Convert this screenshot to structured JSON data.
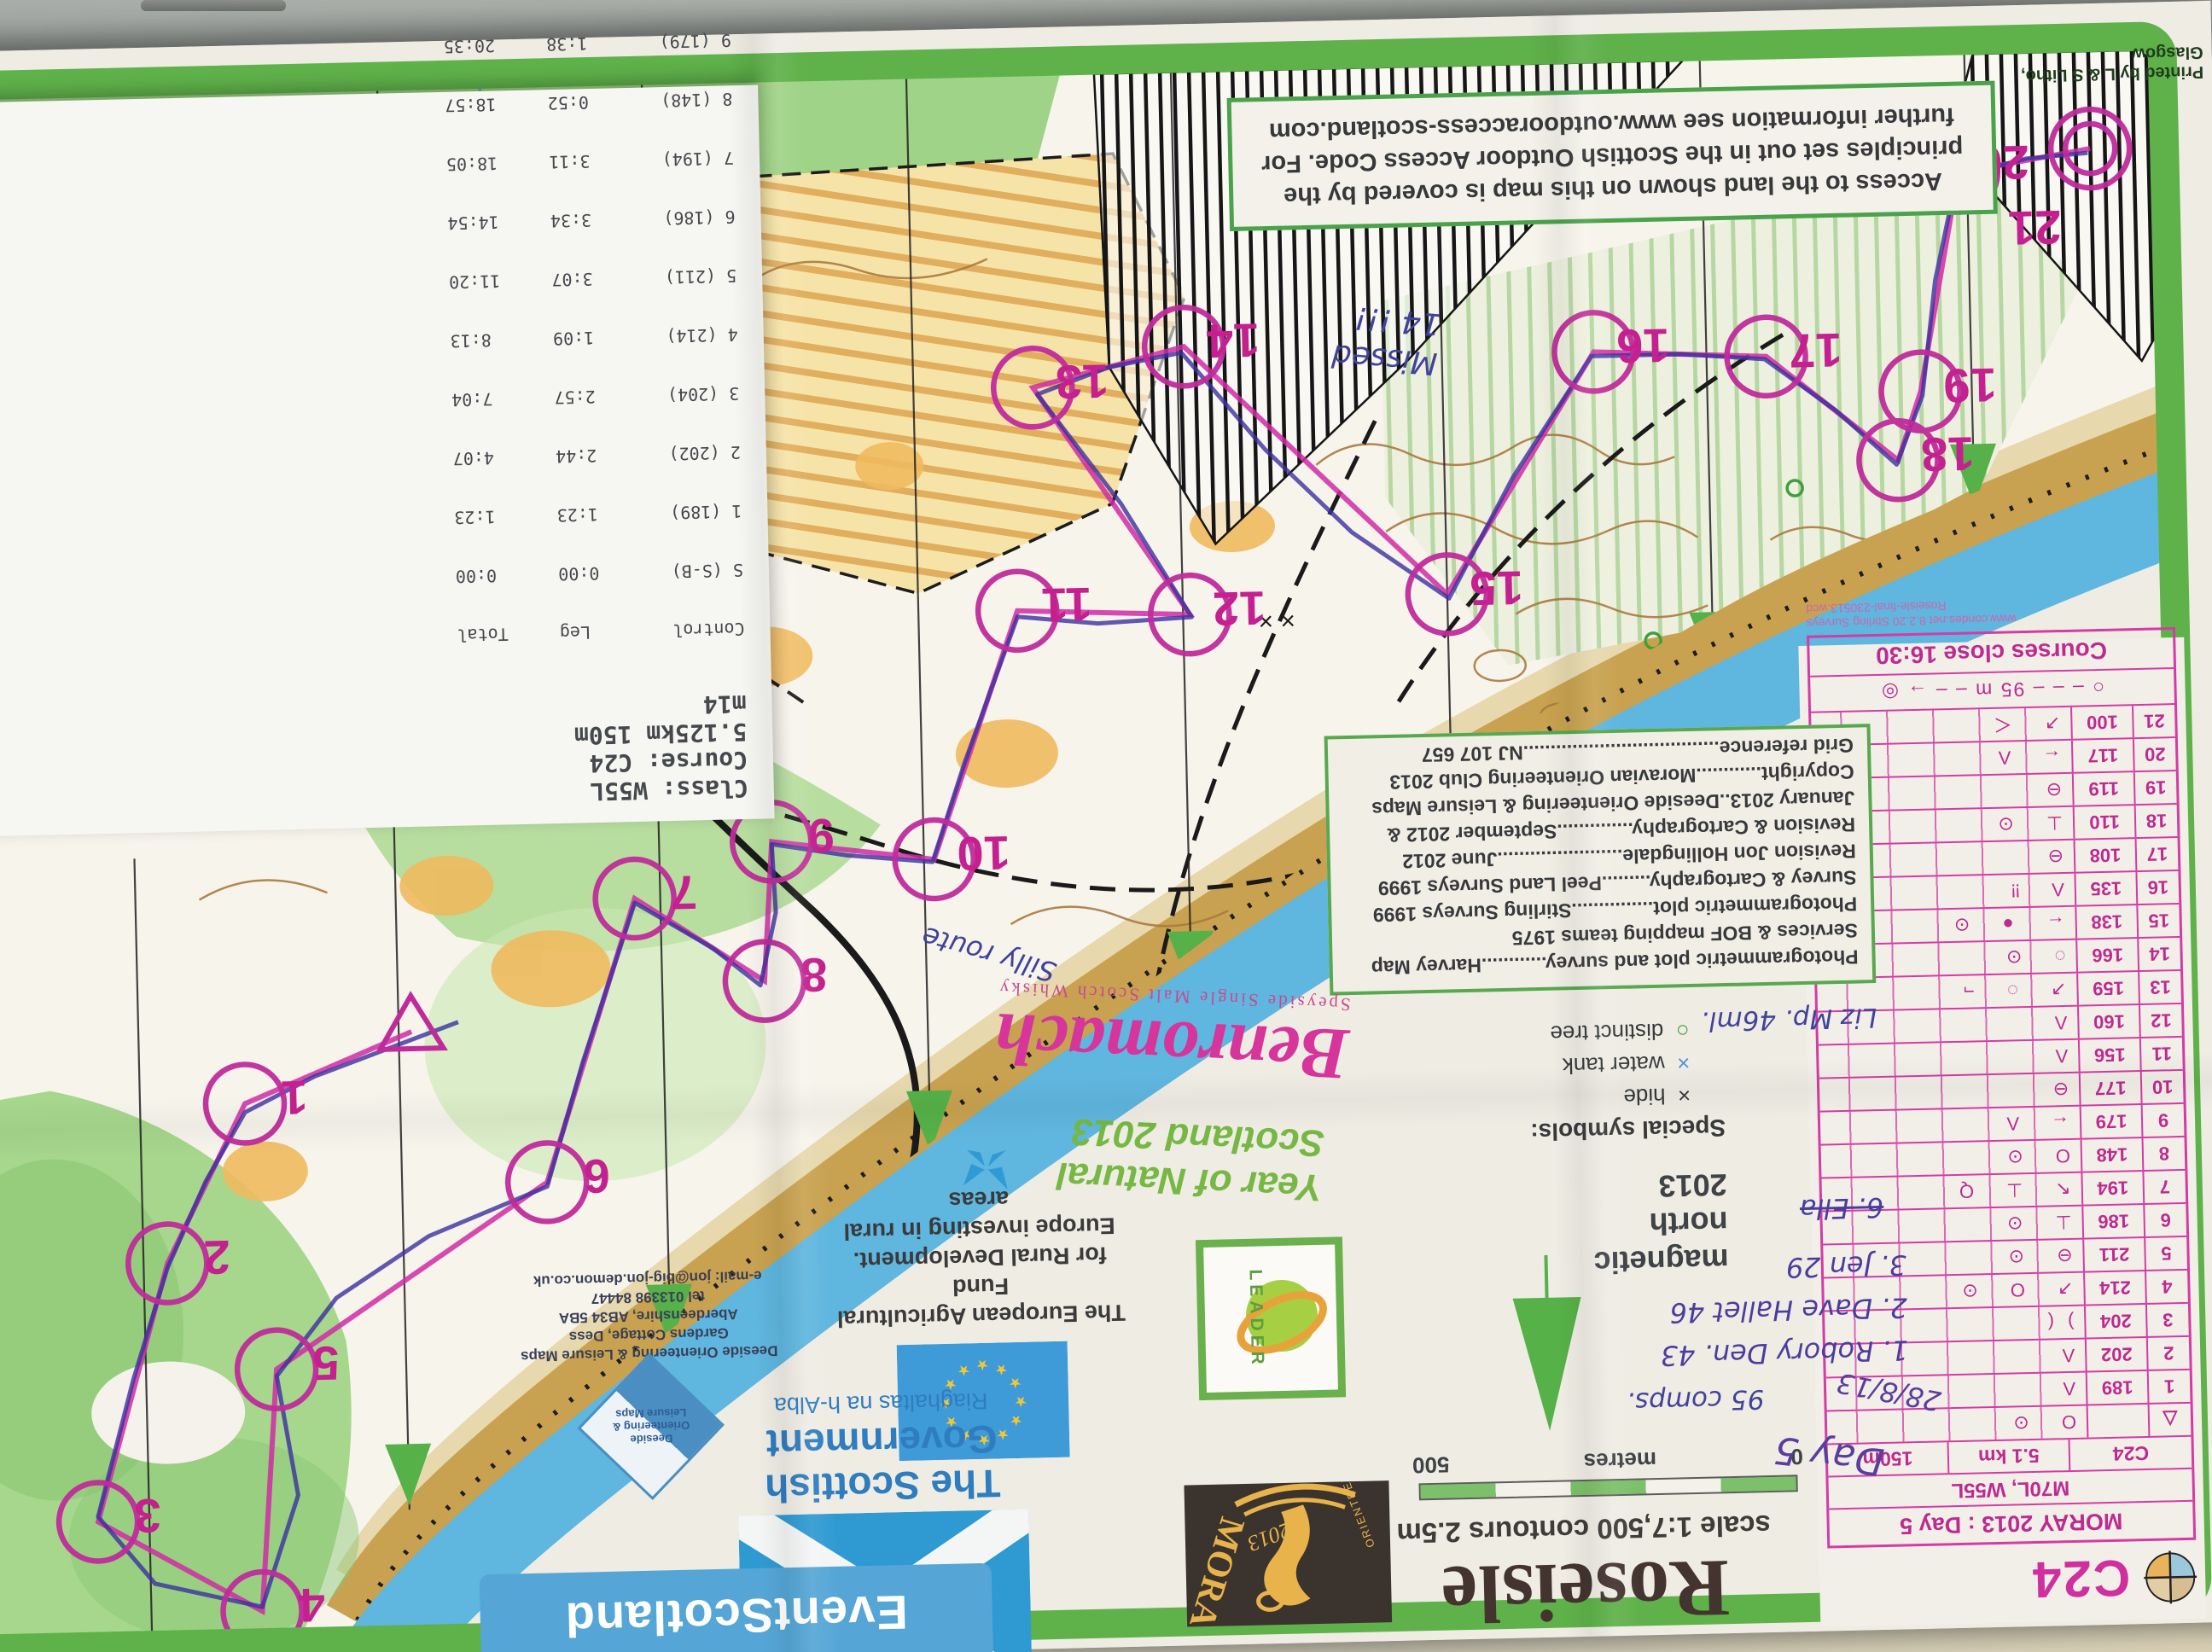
{
  "results_card": {
    "class_line": "Class: W55L",
    "course_line": "Course: C24",
    "distance_line": "5.125km 150m",
    "competitor_line": "m14",
    "header": "Control        Leg     Total",
    "rows": [
      "S (S-B)       0:00      0:00",
      "1 (189)       1:23      1:23",
      "2 (202)       2:44      4:07",
      "3 (204)       2:57      7:04",
      "4 (214)       1:09      8:13",
      "5 (211)       3:07     11:20",
      "6 (186)       3:34     14:54",
      "7 (194)       3:11     18:05",
      "8 (148)       0:52     18:57",
      "9 (179)       1:38     20:35",
      "10 (177)      0:53     21:28",
      "11 (156)      4:16     25:44",
      "12 (160)      1:49     27:33",
      "13 (159)      2:27     30:00",
      "14 (166)     -----     -----",
      "15 (138)     -----     33:55",
      "16 (135)      3:51     37:46",
      "17 (108)      1:40     39:26",
      "18 (110)      2:05     41:31",
      "19 (119)      0:25     41:56",
      "20 (117)      2:33     44:29",
      "21 (100)      1:29     45:58",
      "F (F)         0:21     46:19"
    ],
    "current_leader": "Current leader 43:02",
    "footer": [
      "AutoDownload",
      "SPORTident Event Timing Solution",
      "http://www.sportident.co.uk"
    ]
  },
  "access_box": {
    "lines": [
      "Access to the land shown on this map is covered by the",
      "principles set out in the Scottish Outdoor Access Code.  For",
      "further information see   www.outdooraccess-scotland.com"
    ]
  },
  "printed_by": "Printed by L & S Litho, Glasgow",
  "control_card": {
    "code": "C24",
    "event": "MORAY 2013 : Day 5",
    "classes": "M70L, W55L",
    "course": "C24",
    "length": "5.1 km",
    "climb": "150m",
    "start_symbol": "△",
    "start_syms": "O  ⊙",
    "rows": [
      {
        "n": "1",
        "code": "189",
        "syms": "Λ"
      },
      {
        "n": "2",
        "code": "202",
        "syms": "Λ"
      },
      {
        "n": "3",
        "code": "204",
        "syms": ")("
      },
      {
        "n": "4",
        "code": "214",
        "syms": "↗ O ⊙"
      },
      {
        "n": "5",
        "code": "211",
        "syms": "⊖ ⊙"
      },
      {
        "n": "6",
        "code": "186",
        "syms": "⊥ ⊙"
      },
      {
        "n": "7",
        "code": "194",
        "syms": "↖ ⊥ Q"
      },
      {
        "n": "8",
        "code": "148",
        "syms": "O ⊙"
      },
      {
        "n": "9",
        "code": "179",
        "syms": "← Λ"
      },
      {
        "n": "10",
        "code": "177",
        "syms": "⊖"
      },
      {
        "n": "11",
        "code": "156",
        "syms": "Λ"
      },
      {
        "n": "12",
        "code": "160",
        "syms": "Λ"
      },
      {
        "n": "13",
        "code": "159",
        "syms": "↗ ◌ ¬"
      },
      {
        "n": "14",
        "code": "166",
        "syms": "◌ ⊙"
      },
      {
        "n": "15",
        "code": "138",
        "syms": "← ● ⊙"
      },
      {
        "n": "16",
        "code": "135",
        "syms": "Λ ‼"
      },
      {
        "n": "17",
        "code": "108",
        "syms": "⊖"
      },
      {
        "n": "18",
        "code": "110",
        "syms": "⊥ ⊙"
      },
      {
        "n": "19",
        "code": "119",
        "syms": "⊖"
      },
      {
        "n": "20",
        "code": "117",
        "syms": "← Λ"
      },
      {
        "n": "21",
        "code": "100",
        "syms": "↗ ＜"
      }
    ],
    "finish_row": "○ – – –  95 m  – – → ◎",
    "closes": "Courses close 16:30",
    "small_print": [
      "www.condes.net 8.2.20 Stirling Surveys",
      "Roseisle-final-230513.wcd"
    ]
  },
  "map": {
    "title": "Roseisle",
    "scale_line": "scale 1:7,500   contours 2.5m",
    "scale_bar": {
      "left": "0",
      "mid": "metres",
      "right": "500"
    },
    "north": {
      "line1": "magnetic",
      "line2": "north",
      "line3": "2013"
    },
    "credits": [
      "Photogrammetric plot and survey............Harvey Map",
      "Services & BOF mapping teams 1975",
      "Photogrammetric plot...............Stirling Surveys 1999",
      "Survey & Cartography.........Peel Land Surveys 1999",
      "Revision Jon Hollingdale.......................June 2012",
      "Revision & Cartography..............September 2012 &",
      "January 2013..Deeside Orienteering & Leisure Maps",
      "Copyright............Moravian Orienteering Club 2013",
      "Grid reference....................................NJ 107 657"
    ],
    "special_symbols": {
      "title": "Special symbols:",
      "items": [
        {
          "sym": "×",
          "label": "hide",
          "color": "#3a3a3a"
        },
        {
          "sym": "×",
          "label": "water tank",
          "color": "#5a8fd8"
        },
        {
          "sym": "○",
          "label": "distinct tree",
          "color": "#3da03d"
        }
      ]
    },
    "control_labels": [
      "1",
      "2",
      "3",
      "4",
      "5",
      "6",
      "7",
      "8",
      "9",
      "10",
      "11",
      "12",
      "13",
      "14",
      "15",
      "16",
      "17",
      "18",
      "19",
      "20",
      "21"
    ],
    "colors": {
      "frame": "#5fb14a",
      "course": "#c02b9b",
      "sea": "#5fb6df",
      "forest": "#9fd387",
      "dune": "#c8a250",
      "arrow": "#56b148"
    }
  },
  "logos": {
    "moray": {
      "name": "MORAY",
      "year": "2013",
      "arc": "ORIENTEERING"
    },
    "leader": "LEADER",
    "eu": {
      "lines": [
        "The European Agricultural Fund",
        "for Rural Development.",
        "Europe investing in rural areas"
      ]
    },
    "scotgov": {
      "line1": "The Scottish",
      "line2": "Government",
      "gaelic": "Riaghaltas na h-Alba"
    },
    "eventscotland": "EventScotland",
    "deeside": {
      "diamond": "Deeside Orienteering & Leisure Maps",
      "contact": [
        "Deeside Orienteering & Leisure Maps",
        "Gardens Cottage, Dess",
        "Aberdeenshire, AB34 5BA",
        "tel 013398 84447",
        "e-mail:  jon@big-jon.demon.co.uk"
      ]
    },
    "benromach": {
      "name": "Benromach",
      "tagline": "Speyside Single Malt Scotch Whisky"
    },
    "natural_scotland": {
      "line1": "Year of Natural",
      "line2": "Scotland 2013"
    }
  },
  "handwriting": {
    "missed1": "Missed",
    "missed2": "14 !!!",
    "silly": "Silly route",
    "liz": "Liz Mp. 46ml.",
    "day": "Day 5",
    "date": "28/8/13",
    "comps": "95 comps.",
    "places": [
      "1. Robory Den. 43",
      "2. Dave Hallet 46",
      "3. Jen 29"
    ],
    "ella": "6. Ella"
  }
}
